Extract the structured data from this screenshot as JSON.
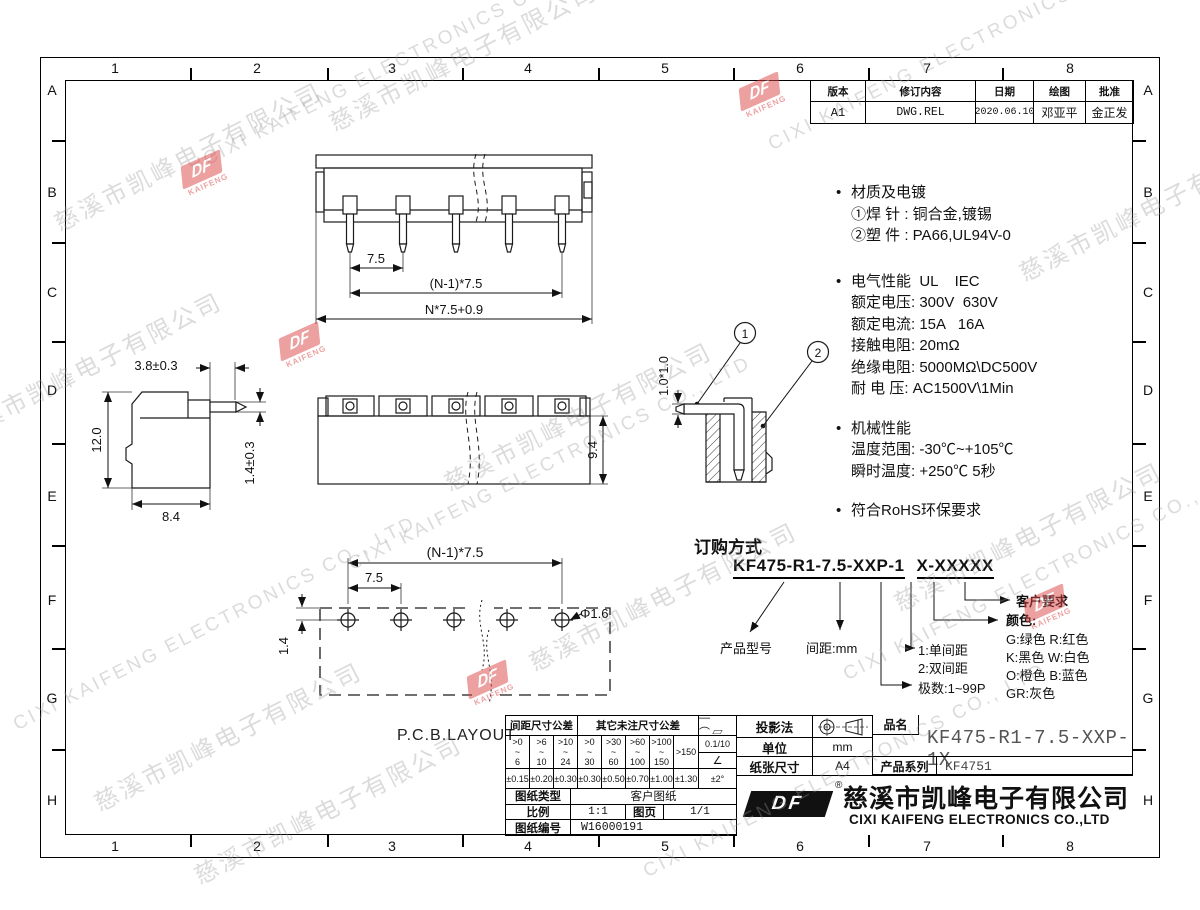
{
  "zones": {
    "cols": [
      "1",
      "2",
      "3",
      "4",
      "5",
      "6",
      "7",
      "8"
    ],
    "rows": [
      "A",
      "B",
      "C",
      "D",
      "E",
      "F",
      "G",
      "H"
    ]
  },
  "watermark": {
    "cn": "慈溪市凯峰电子有限公司",
    "en": "CIXI KAIFENG ELECTRONICS CO., LTD",
    "logo_df": "DF",
    "logo_sub": "KAIFENG"
  },
  "revision": {
    "headers": [
      "版本",
      "修订内容",
      "日期",
      "绘图",
      "批准"
    ],
    "row": [
      "A1",
      "DWG.REL",
      "2020.06.10",
      "邓亚平",
      "金正发"
    ]
  },
  "specs": {
    "s1_title": "材质及电镀",
    "s1_lines": [
      "①焊 针 : 铜合金,镀锡",
      "②塑 件 : PA66,UL94V-0"
    ],
    "s2_title": "电气性能  UL    IEC",
    "s2_lines": [
      "额定电压: 300V  630V",
      "额定电流: 15A   16A",
      "接触电阻: 20mΩ",
      "绝缘电阻: 5000MΩ\\DC500V",
      "耐 电 压: AC1500V\\1Min"
    ],
    "s3_title": "机械性能",
    "s3_lines": [
      "温度范围: -30℃~+105℃",
      "瞬时温度: +250℃ 5秒"
    ],
    "s4_title": "符合RoHS环保要求"
  },
  "ordering": {
    "title": "订购方式",
    "pn_main": "KF475-R1-7.5-XXP-1",
    "pn_suffix": "X-XXXXX",
    "lbl_model": "产品型号",
    "lbl_pitch": "间距:mm",
    "lbl_row1": "1:单间距",
    "lbl_row2": "2:双间距",
    "lbl_poles": "极数:1~99P",
    "lbl_color_title": "颜色:",
    "color_lines": [
      "G:绿色  R:红色",
      "K:黑色  W:白色",
      "O:橙色  B:蓝色",
      "GR:灰色"
    ],
    "lbl_customer": "客户要求"
  },
  "drawing": {
    "dim_pitch": "7.5",
    "dim_n1": "(N-1)*7.5",
    "dim_total": "N*7.5+0.9",
    "dim_38": "3.8±0.3",
    "dim_12": "12.0",
    "dim_14": "1.4±0.3",
    "dim_84": "8.4",
    "dim_94": "9.4",
    "dim_1010": "1.0*1.0",
    "dim_pcb_n1": "(N-1)*7.5",
    "dim_pcb_pitch": "7.5",
    "dim_pcb_14": "1.4",
    "dim_hole": "Φ1.6",
    "pcb_label": "P.C.B.LAYOUT",
    "callout1": "1",
    "callout2": "2"
  },
  "title_block": {
    "tol1_header": "间距尺寸公差",
    "tol2_header": "其它未注尺寸公差",
    "ranges": [
      [
        ">0",
        "~",
        "6"
      ],
      [
        ">6",
        "~",
        "10"
      ],
      [
        ">10",
        "~",
        "24"
      ],
      [
        ">0",
        "~",
        "30"
      ],
      [
        ">30",
        "~",
        "60"
      ],
      [
        ">60",
        "~",
        "100"
      ],
      [
        ">100",
        "~",
        "150"
      ]
    ],
    "range_last": ">150",
    "values": [
      "±0.15",
      "±0.20",
      "±0.30",
      "±0.30",
      "±0.50",
      "±0.70",
      "±1.00",
      "±1.30"
    ],
    "geo_symbols": "—⌒▱",
    "flatness": "0.1/10",
    "angle_symbol": "∠",
    "angle_tol": "±2°",
    "projection_label": "投影法",
    "unit_label": "单位",
    "unit_value": "mm",
    "paper_label": "纸张尺寸",
    "paper_value": "A4",
    "name_label": "品名",
    "name_value": "KF475-R1-7.5-XXP-1X",
    "series_label": "产品系列",
    "series_value": "KF4751",
    "type_label": "图纸类型",
    "type_value": "客户图纸",
    "scale_label": "比例",
    "scale_value": "1:1",
    "sheet_label": "图页",
    "sheet_value": "1/1",
    "no_label": "图纸编号",
    "no_value": "W16000191",
    "logo_df": "DF",
    "reg": "®",
    "company_cn": "慈溪市凯峰电子有限公司",
    "company_en": "CIXI KAIFENG ELECTRONICS CO.,LTD"
  }
}
